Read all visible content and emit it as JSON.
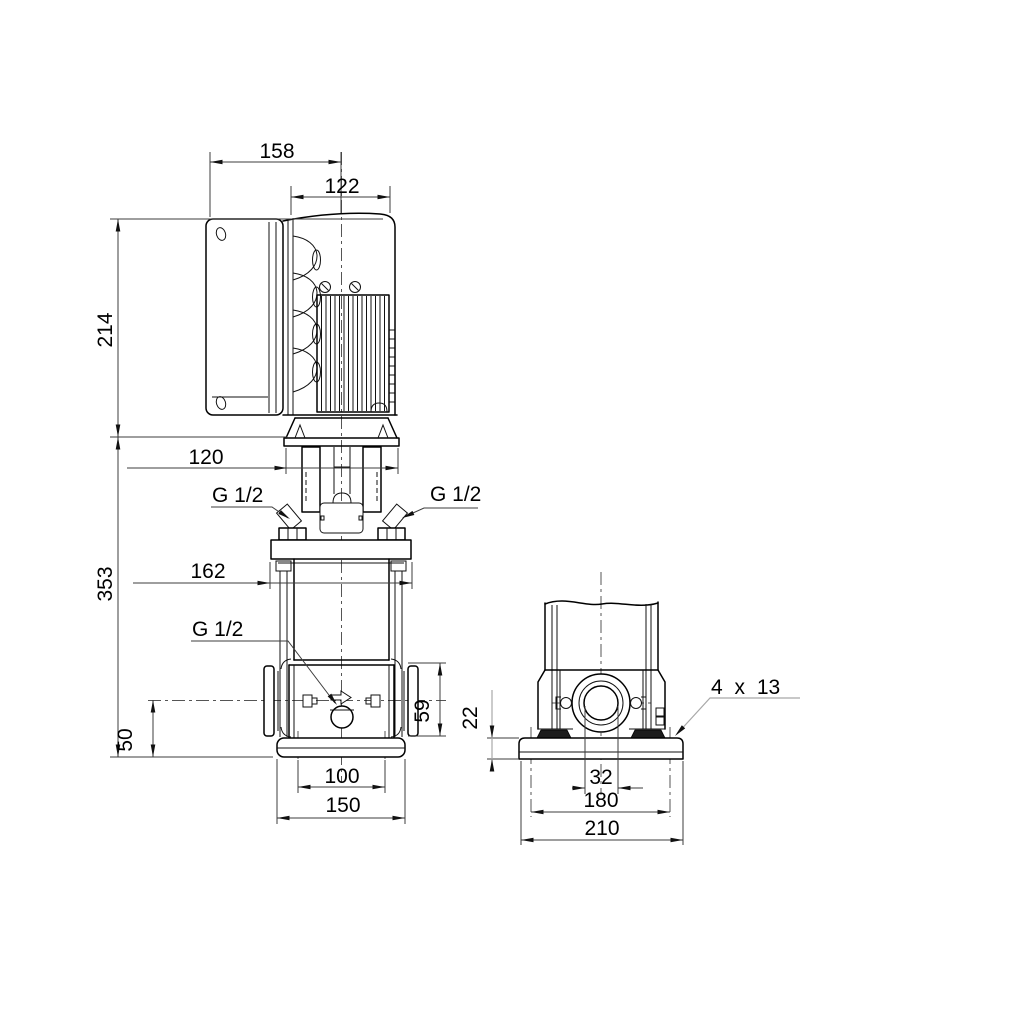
{
  "colors": {
    "background": "#ffffff",
    "object_line": "#000000",
    "dimension_line": "#3c3c3c",
    "leader_gray": "#a8a8a8"
  },
  "elevation_view": {
    "dim_cover_width": "158",
    "dim_motor_width": "122",
    "dim_motor_height": "214",
    "dim_motor_flange_width": "120",
    "dim_total_height": "353",
    "dim_head_flange_width": "162",
    "label_vent_left": "G 1/2",
    "label_vent_right": "G 1/2",
    "label_drain": "G 1/2",
    "dim_port_flange_height": "59",
    "dim_port_axis_height": "50",
    "dim_foot_hole_spacing": "100",
    "dim_foot_width": "150"
  },
  "end_view": {
    "dim_baseplate_thickness": "22",
    "dim_port_bore": "32",
    "dim_hole_spacing": "180",
    "dim_baseplate_width": "210",
    "label_mounting_holes": "4 x 13"
  }
}
